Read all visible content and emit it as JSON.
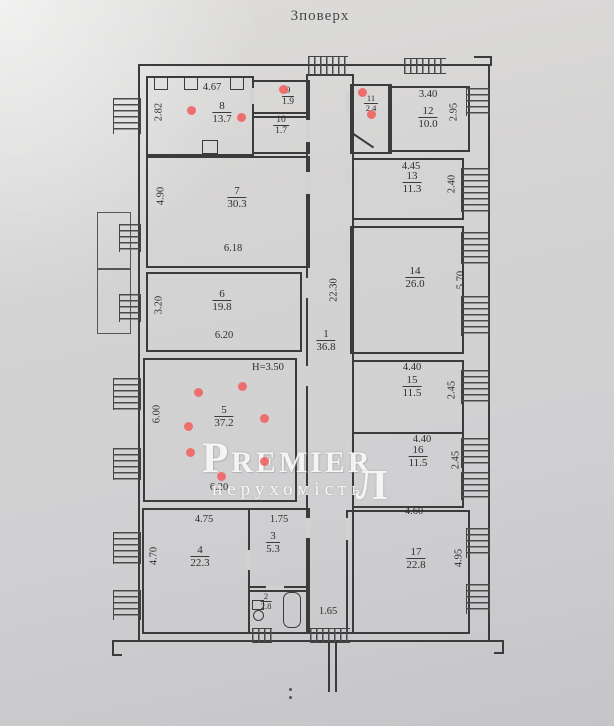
{
  "title": "3поверх",
  "watermark": {
    "brand": "Premier",
    "tagline": "нерухомість",
    "logo": "Л"
  },
  "rooms": {
    "r1": {
      "number": "1",
      "area": "36.8"
    },
    "r2": {
      "number": "2",
      "area": "2.8"
    },
    "r3": {
      "number": "3",
      "area": "5.3"
    },
    "r4": {
      "number": "4",
      "area": "22.3"
    },
    "r5": {
      "number": "5",
      "area": "37.2"
    },
    "r6": {
      "number": "6",
      "area": "19.8"
    },
    "r7": {
      "number": "7",
      "area": "30.3"
    },
    "r8": {
      "number": "8",
      "area": "13.7"
    },
    "r9": {
      "number": "9",
      "area": "1.9"
    },
    "r10": {
      "number": "10",
      "area": "1.7"
    },
    "r11": {
      "number": "11",
      "area": "2.4"
    },
    "r12": {
      "number": "12",
      "area": "10.0"
    },
    "r13": {
      "number": "13",
      "area": "11.3"
    },
    "r14": {
      "number": "14",
      "area": "26.0"
    },
    "r15": {
      "number": "15",
      "area": "11.5"
    },
    "r16": {
      "number": "16",
      "area": "11.5"
    },
    "r17": {
      "number": "17",
      "area": "22.8"
    }
  },
  "dimensions": {
    "r8_top": "4.67",
    "r8_left": "2.82",
    "r7_left": "4.90",
    "r7_bottom": "6.18",
    "r6_left": "3.20",
    "r6_bottom": "6.20",
    "r5_left": "6.00",
    "r5_bottom": "6.20",
    "r5_height": "H=3.50",
    "r4_top": "4.75",
    "r4_left": "4.70",
    "r3_top": "1.75",
    "r12_top": "3.40",
    "r12_right": "2.95",
    "r13_top": "4.45",
    "r13_right": "2.40",
    "r14_right": "5.70",
    "r15_top": "4.40",
    "r15_right": "2.45",
    "r16_top": "4.40",
    "r16_right": "2.45",
    "r17_top": "4.60",
    "r17_right": "4.95",
    "corridor_v": "22.30",
    "corridor_bottom": "1.65"
  },
  "colors": {
    "annotation_red": "#ef615e",
    "ink": "#3b3b3b",
    "paper": "#d5d4d4",
    "watermark": "#faf9f7"
  }
}
